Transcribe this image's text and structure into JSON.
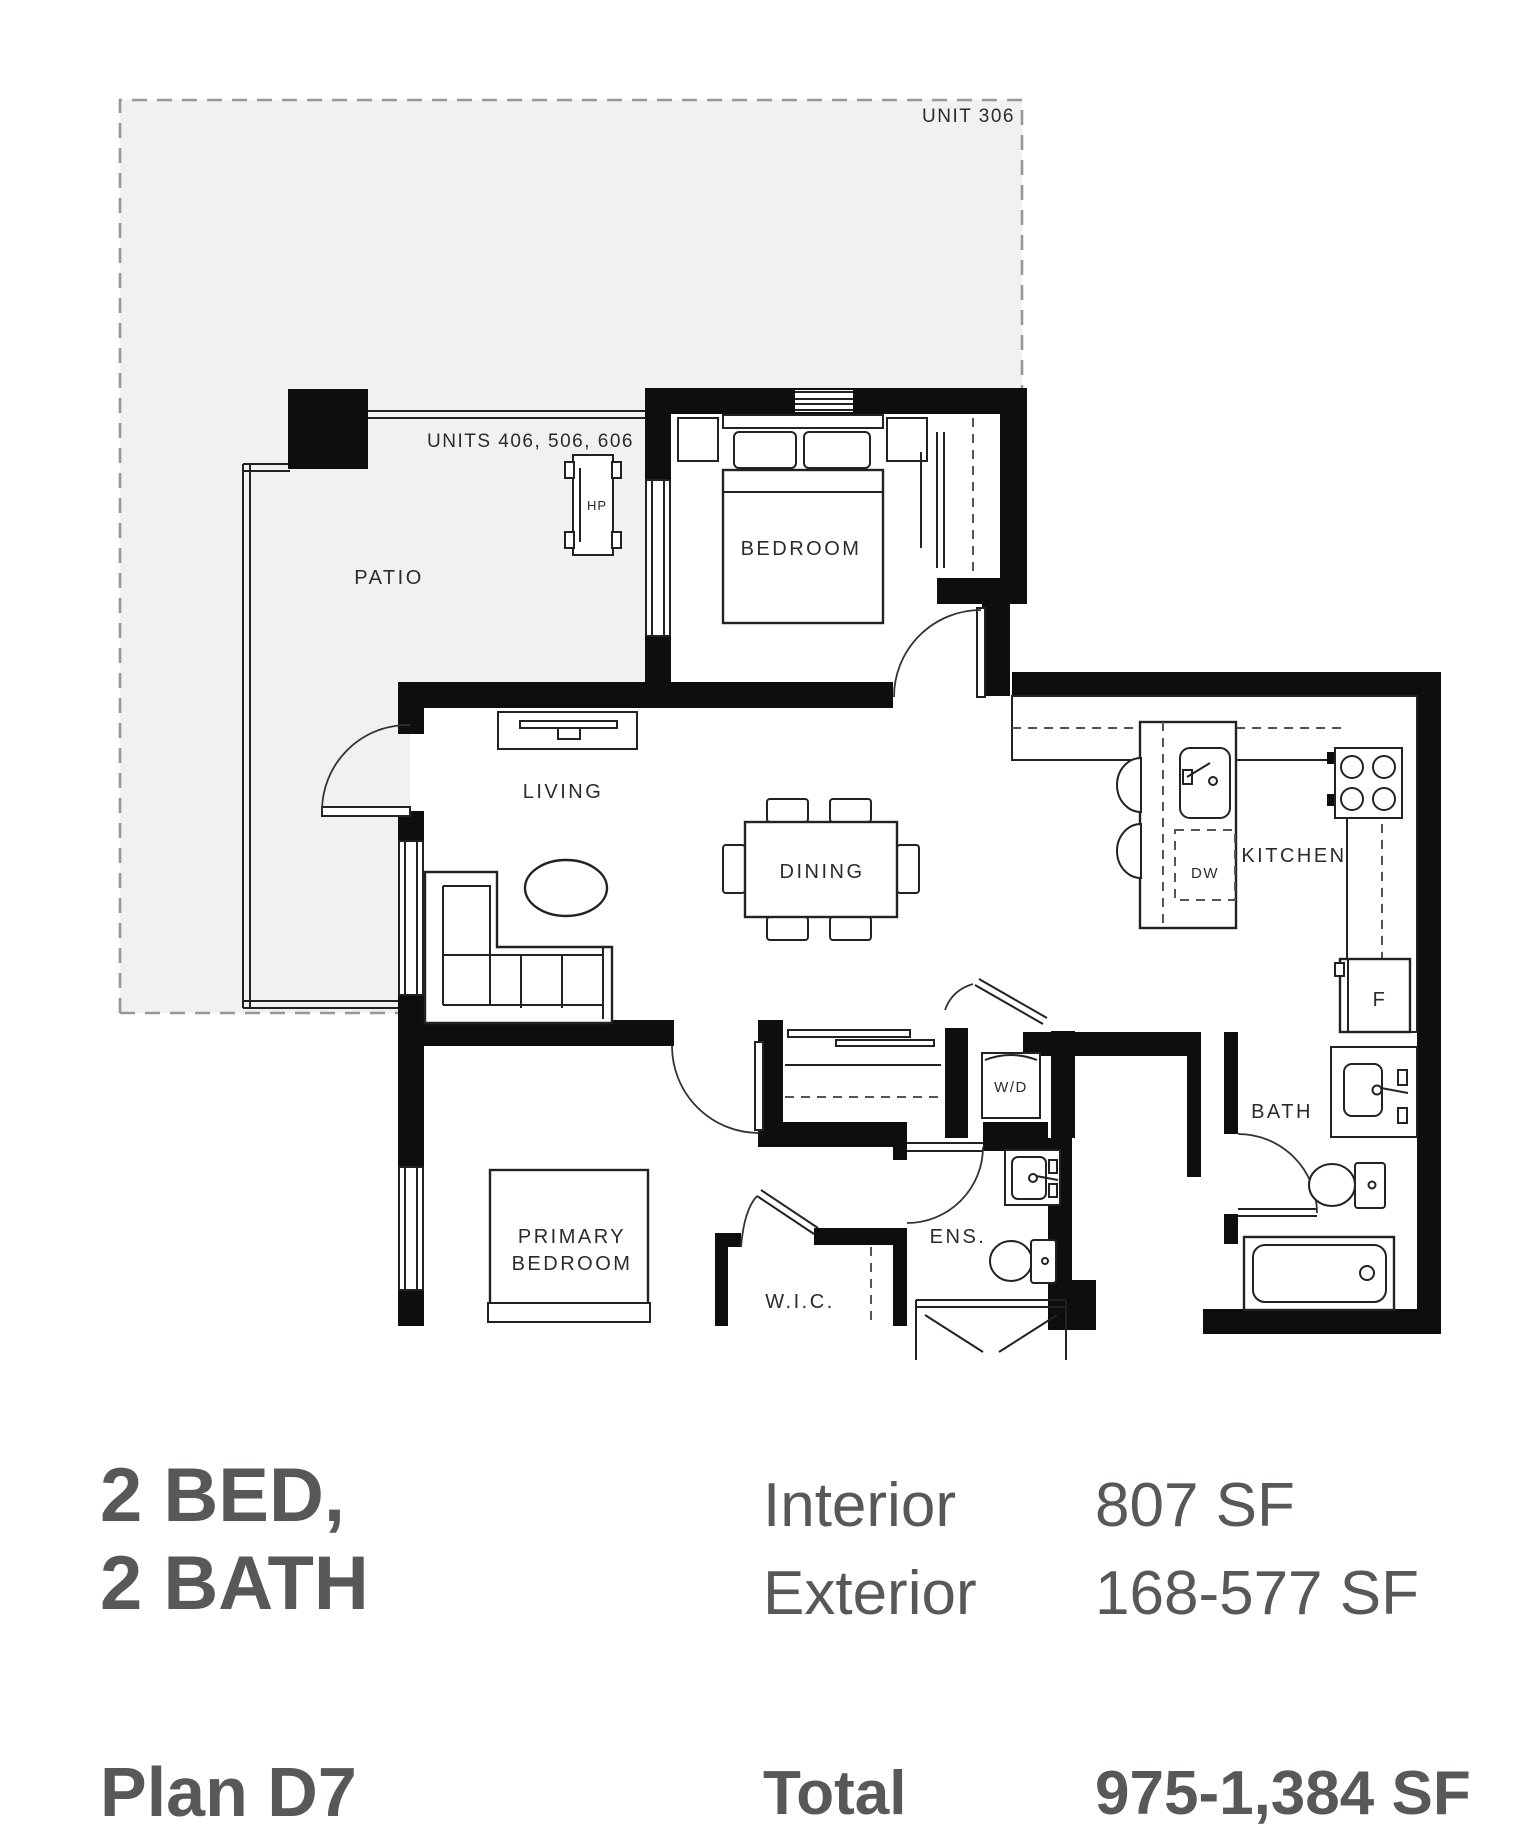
{
  "floorplan": {
    "unit_note_top": "UNIT 306",
    "unit_note_patio": "UNITS 406, 506, 606",
    "rooms": {
      "patio": "PATIO",
      "bedroom": "BEDROOM",
      "living": "LIVING",
      "dining": "DINING",
      "kitchen": "KITCHEN",
      "primary_bedroom_line1": "PRIMARY",
      "primary_bedroom_line2": "BEDROOM",
      "wic": "W.I.C.",
      "ens": "ENS.",
      "bath": "BATH"
    },
    "appliances": {
      "heat_pump": "HP",
      "dishwasher": "DW",
      "fridge": "F",
      "washer_dryer": "W/D"
    }
  },
  "summary": {
    "bed_bath_line1": "2 BED,",
    "bed_bath_line2": "2 BATH",
    "plan_name": "Plan D7",
    "rows": [
      {
        "label": "Interior",
        "value": "807 SF"
      },
      {
        "label": "Exterior",
        "value": "168-577 SF"
      },
      {
        "label": "Total",
        "value": "975-1,384 SF"
      }
    ]
  },
  "colors": {
    "wall": "#0e0e0e",
    "line": "#222222",
    "patio_fill": "#f0f1f0",
    "dashed_boundary": "#979797",
    "summary_text": "#57585a"
  }
}
